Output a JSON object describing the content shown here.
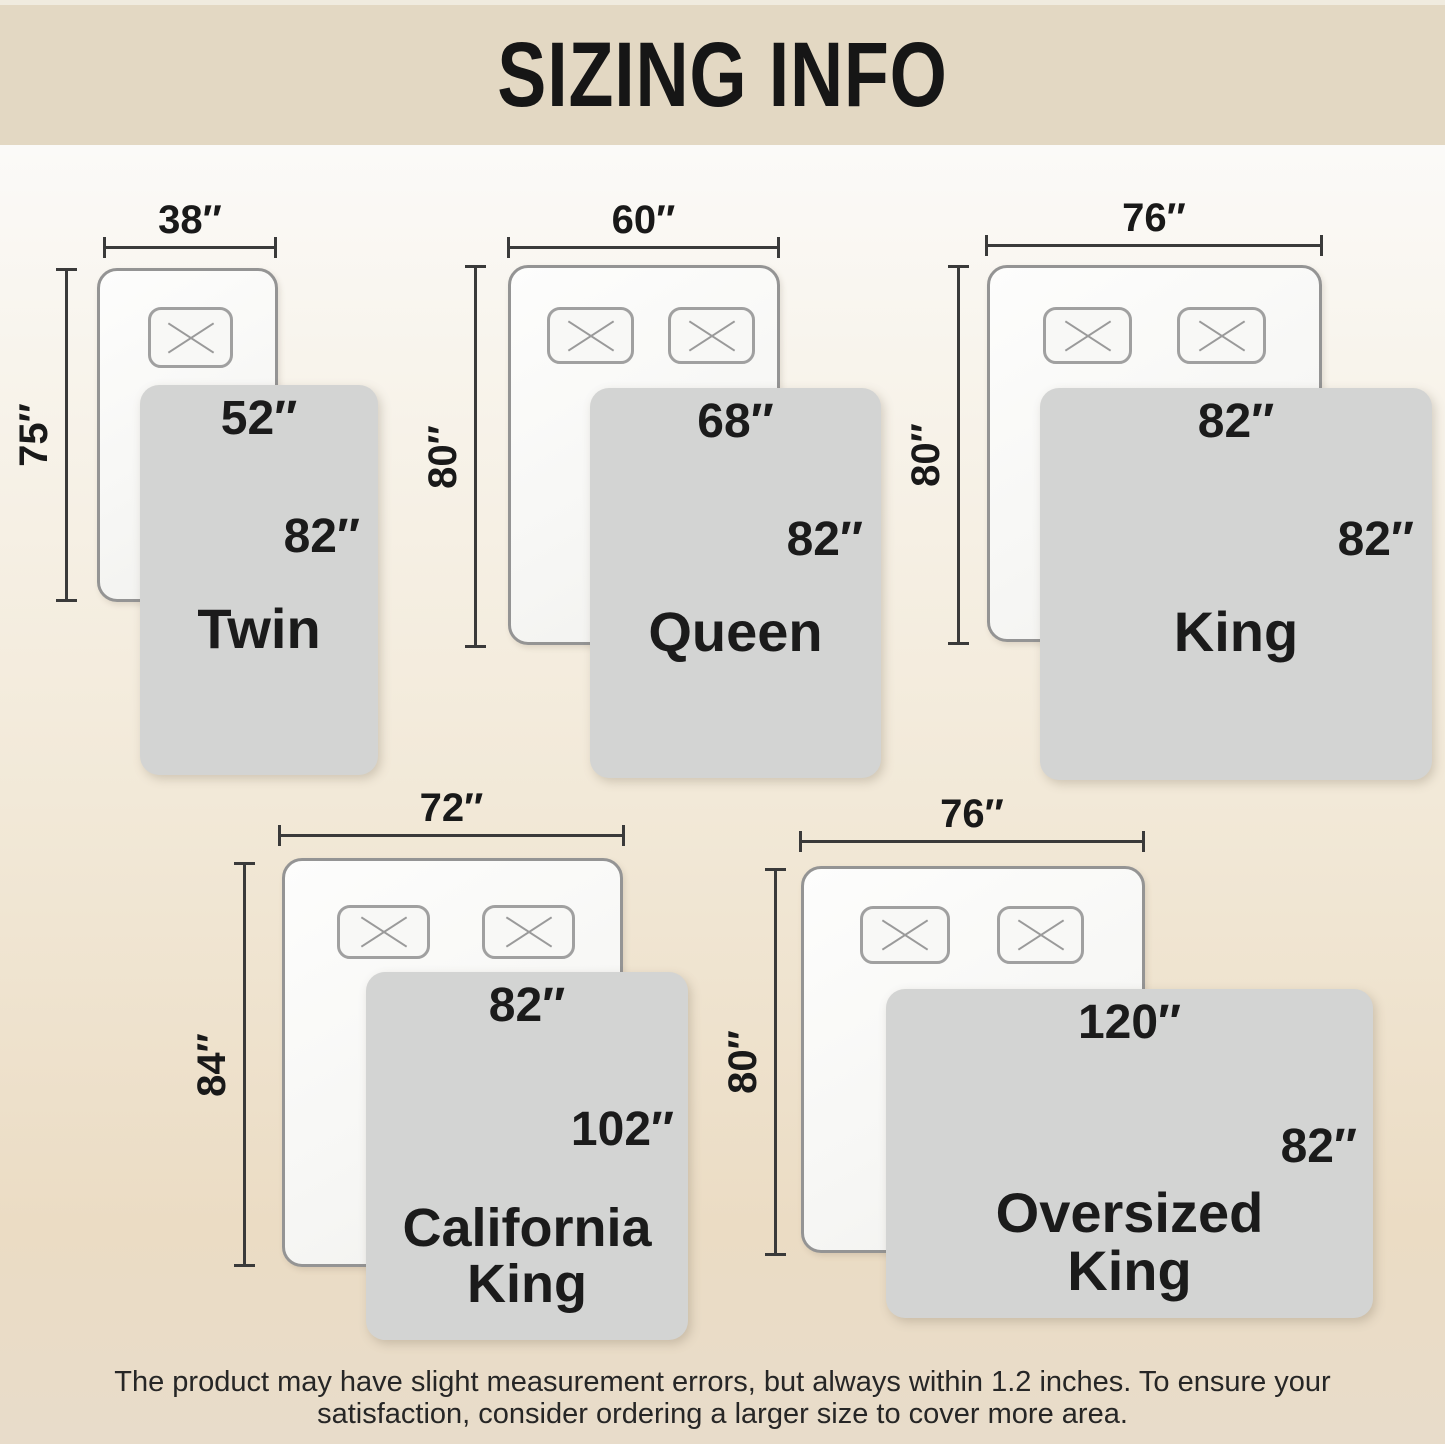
{
  "header": {
    "title": "SIZING INFO"
  },
  "sizes": [
    {
      "name": "Twin",
      "bed_width": "38″",
      "bed_length": "75″",
      "blanket_width": "52″",
      "blanket_length": "82″",
      "pillow_count": 1
    },
    {
      "name": "Queen",
      "bed_width": "60″",
      "bed_length": "80″",
      "blanket_width": "68″",
      "blanket_length": "82″",
      "pillow_count": 2
    },
    {
      "name": "King",
      "bed_width": "76″",
      "bed_length": "80″",
      "blanket_width": "82″",
      "blanket_length": "82″",
      "pillow_count": 2
    },
    {
      "name": "California King",
      "bed_width": "72″",
      "bed_length": "84″",
      "blanket_width": "82″",
      "blanket_length": "102″",
      "pillow_count": 2
    },
    {
      "name": "Oversized King",
      "bed_width": "76″",
      "bed_length": "80″",
      "blanket_width": "120″",
      "blanket_length": "82″",
      "pillow_count": 2
    }
  ],
  "footer": {
    "line1": "The product may have slight measurement errors, but always within 1.2 inches. To ensure your",
    "line2": "satisfaction, consider ordering a larger size to cover more area."
  },
  "colors": {
    "header_bg": "#e3d8c3",
    "background_top": "#fbfaf8",
    "background_bottom": "#e8dcca",
    "blanket": "#d3d4d3",
    "bed_fill": "#f8f8f6",
    "bed_border": "#949494",
    "dimension_line": "#3a3a3a",
    "text": "#1b1b1b"
  }
}
